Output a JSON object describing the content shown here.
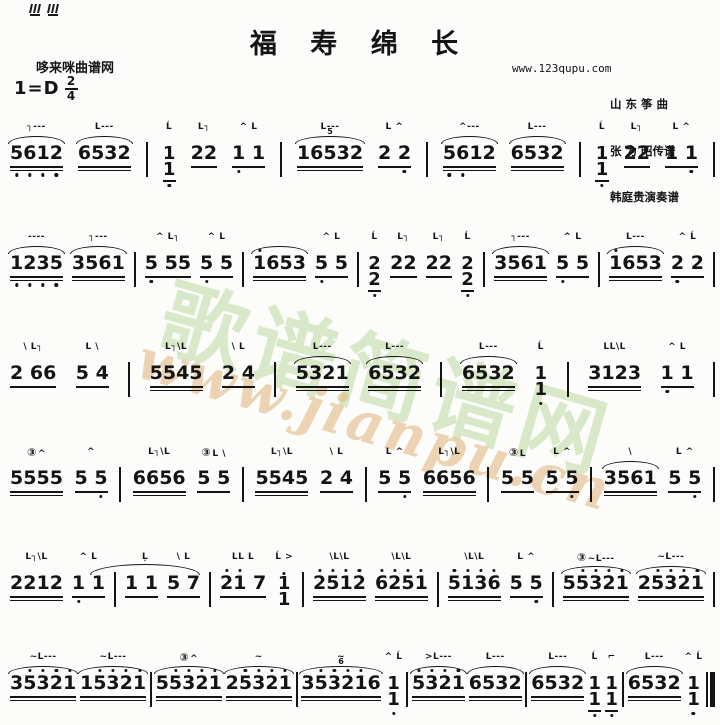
{
  "page_background": "#fcfcfa",
  "ink_color": "#141414",
  "header": {
    "title": "福 寿 绵 长",
    "site_left": "哆来咪曲谱网",
    "site_right": "www.123qupu.com",
    "key_signature": "1=D",
    "time_signature": {
      "numerator": "2",
      "denominator": "4"
    },
    "credits": [
      "山 东 筝 曲",
      "张 为 昭传谱",
      "韩庭贵演奏谱"
    ]
  },
  "watermark": {
    "site_name": "歌谱简谱网",
    "site_url": "www.jianpu.cn",
    "name_color": "#b5d698",
    "url_color": "#e2b984"
  },
  "score": {
    "notation_legend": {
      "m": "zheng-technique-marks-above",
      "a": "slur-arc",
      "t": "note-digits",
      "s": "stacked-octave-dyad",
      "u": "beam-underline-count",
      "db": "low-octave-dot-positions",
      "sd": "high-octave-dot-positions",
      "c": "circled-string-number",
      "tp": "tuplet-number",
      "tie": "tie-across-barline",
      "b": "barline (2 = final double bar)"
    },
    "lines": [
      [
        {
          "m": "┐---",
          "a": 1,
          "t": "5612",
          "u": 2,
          "db": [
            0,
            1,
            2,
            3
          ]
        },
        {
          "m": "L---",
          "a": 1,
          "t": "6532",
          "u": 2
        },
        {
          "b": 1
        },
        {
          "m": "Ĺ",
          "s": [
            "1",
            "1"
          ],
          "u": 1,
          "db": [
            0
          ]
        },
        {
          "m": "L┐",
          "t": "22",
          "u": 1
        },
        {
          "m": "^ L",
          "t": "1 1",
          "u": 1,
          "db": [
            0
          ]
        },
        {
          "b": 1
        },
        {
          "m": "L---",
          "a": 1,
          "tp": "5",
          "t": "16532",
          "u": 2
        },
        {
          "m": "L ^",
          "t": "2 2",
          "u": 1,
          "db": [
            2
          ]
        },
        {
          "b": 1
        },
        {
          "m": "^---",
          "a": 1,
          "t": "5612",
          "u": 2,
          "db": [
            0,
            1
          ]
        },
        {
          "m": "L---",
          "a": 1,
          "t": "6532",
          "u": 2
        },
        {
          "b": 1
        },
        {
          "m": "Ĺ",
          "s": [
            "1",
            "1"
          ],
          "u": 1,
          "db": [
            0
          ]
        },
        {
          "m": "L┐",
          "t": "22",
          "u": 1
        },
        {
          "m": "L ^",
          "t": "1 1",
          "u": 1,
          "db": [
            2
          ]
        },
        {
          "b": 1
        }
      ],
      [
        {
          "m": "----",
          "a": 1,
          "t": "1235",
          "u": 2,
          "db": [
            0,
            1,
            2,
            3
          ]
        },
        {
          "m": "┐---",
          "a": 1,
          "t": "3561",
          "u": 2
        },
        {
          "b": 1
        },
        {
          "m": "^ L┐",
          "t": "5 55",
          "u": 1,
          "db": [
            0
          ]
        },
        {
          "m": "^ L",
          "t": "5 5",
          "u": 1,
          "db": [
            0
          ]
        },
        {
          "b": 1
        },
        {
          "m": "",
          "a": 1,
          "t": "1653",
          "sd": [
            0
          ],
          "u": 2
        },
        {
          "m": "^ L",
          "t": "5 5",
          "u": 1,
          "db": [
            0
          ]
        },
        {
          "b": 1
        },
        {
          "m": "Ĺ",
          "s": [
            "2",
            "2"
          ],
          "u": 1,
          "db": [
            0
          ]
        },
        {
          "m": "L┐",
          "t": "22",
          "u": 1
        },
        {
          "m": "L┐",
          "t": "22",
          "u": 1
        },
        {
          "m": "Ĺ",
          "s": [
            "2",
            "2"
          ],
          "u": 1,
          "db": [
            0
          ]
        },
        {
          "b": 1
        },
        {
          "m": "┐---",
          "a": 1,
          "t": "3561",
          "u": 2
        },
        {
          "m": "^ L",
          "t": "5 5",
          "u": 1,
          "db": [
            0
          ]
        },
        {
          "b": 1
        },
        {
          "m": "L---",
          "a": 1,
          "t": "1653",
          "sd": [
            0
          ],
          "u": 2
        },
        {
          "m": "^ Ĺ",
          "t": "2 2",
          "u": 1,
          "db": [
            0
          ]
        },
        {
          "b": 1
        }
      ],
      [
        {
          "m": "\\ L┐",
          "t": "2 66",
          "u": 1
        },
        {
          "m": "L \\",
          "t": "5 4",
          "u": 1
        },
        {
          "b": 1
        },
        {
          "m": "L┐\\L",
          "t": "5545",
          "u": 2
        },
        {
          "m": "\\ L",
          "t": "2 4",
          "u": 1
        },
        {
          "b": 1
        },
        {
          "m": "L---",
          "a": 1,
          "t": "5321",
          "u": 2
        },
        {
          "m": "L---",
          "a": 1,
          "t": "6532",
          "u": 2
        },
        {
          "b": 1
        },
        {
          "m": "L---",
          "a": 1,
          "t": "6532",
          "u": 2
        },
        {
          "m": "Ĺ",
          "s": [
            "1",
            "1"
          ],
          "db": [
            0
          ]
        },
        {
          "b": 1
        },
        {
          "m": "LL\\L",
          "t": "3123",
          "u": 2
        },
        {
          "m": "^ L",
          "t": "1 1",
          "u": 1,
          "db": [
            0
          ]
        },
        {
          "b": 1
        }
      ],
      [
        {
          "c": "③",
          "m": "^",
          "t": "5555",
          "u": 2
        },
        {
          "m": "^",
          "t": "5 5",
          "u": 1,
          "db": [
            2
          ]
        },
        {
          "b": 1
        },
        {
          "m": "L┐\\L",
          "t": "6656",
          "u": 2
        },
        {
          "c": "③",
          "m": "L \\",
          "t": "5 5",
          "u": 1
        },
        {
          "b": 1
        },
        {
          "m": "L┐\\L",
          "t": "5545",
          "u": 2
        },
        {
          "m": "\\ L",
          "t": "2 4",
          "u": 1
        },
        {
          "b": 1
        },
        {
          "m": "L ^",
          "t": "5 5",
          "u": 1,
          "db": [
            2
          ]
        },
        {
          "m": "L┐\\L",
          "t": "6656",
          "u": 2
        },
        {
          "b": 1
        },
        {
          "c": "③",
          "m": "L",
          "t": "5 5",
          "u": 1
        },
        {
          "m": "L ^",
          "t": "5 5",
          "u": 1,
          "db": [
            2
          ]
        },
        {
          "b": 1
        },
        {
          "m": "\\",
          "a": 1,
          "t": "3561",
          "u": 2
        },
        {
          "m": "L ^",
          "t": "5 5",
          "u": 1,
          "db": [
            2
          ]
        },
        {
          "b": 1
        }
      ],
      [
        {
          "m": "L┐\\L",
          "t": "2212",
          "u": 2
        },
        {
          "m": "^ L",
          "t": "1 1",
          "u": 1,
          "db": [
            0
          ],
          "tie": 1
        },
        {
          "b": 1
        },
        {
          "m": "  Ļ",
          "t": "1 1",
          "u": 1
        },
        {
          "m": "\\ L",
          "t": "5 7",
          "u": 1
        },
        {
          "b": 1
        },
        {
          "m": "LL L",
          "t": "21 7",
          "sd": [
            0,
            1
          ],
          "u": 1
        },
        {
          "m": "Ĺ >",
          "s": [
            "1",
            "1"
          ],
          "ssd": 1
        },
        {
          "b": 1
        },
        {
          "m": "\\L\\L",
          "t": "2512",
          "sd": [
            0,
            1,
            2,
            3
          ],
          "u": 2
        },
        {
          "m": "\\L\\L",
          "t": "6251",
          "sd": [
            0,
            1,
            2,
            3
          ],
          "u": 2
        },
        {
          "b": 1
        },
        {
          "m": "\\L\\L",
          "t": "5136",
          "sd": [
            0,
            1,
            2,
            3
          ],
          "u": 2
        },
        {
          "m": "L ^",
          "t": "5 5",
          "u": 1,
          "db": [
            2
          ]
        },
        {
          "b": 1
        },
        {
          "c": "③",
          "m": "~L---",
          "a": 1,
          "t": "55321",
          "sd": [
            1,
            2,
            3,
            4
          ],
          "u": 2
        },
        {
          "m": "~L---",
          "a": 1,
          "t": "25321",
          "sd": [
            1,
            2,
            3,
            4
          ],
          "u": 2
        },
        {
          "b": 1
        }
      ],
      [
        {
          "m": "~L---",
          "a": 1,
          "t": "35321",
          "sd": [
            1,
            2,
            3,
            4
          ],
          "u": 2
        },
        {
          "m": "~L---",
          "a": 1,
          "t": "15321",
          "sd": [
            1,
            2,
            3,
            4
          ],
          "u": 2
        },
        {
          "b": 1
        },
        {
          "c": "③",
          "m": "^",
          "a": 1,
          "t": "55321",
          "sd": [
            1,
            2,
            3,
            4
          ],
          "u": 2
        },
        {
          "m": "~",
          "a": 1,
          "t": "25321",
          "sd": [
            1,
            2,
            3,
            4
          ],
          "u": 2
        },
        {
          "b": 1
        },
        {
          "m": "~",
          "a": 1,
          "tp": "6",
          "t": "353216",
          "sd": [
            1,
            2,
            3,
            4
          ],
          "u": 2
        },
        {
          "m": "^ Ĺ",
          "s": [
            "1",
            "1"
          ],
          "db": [
            0
          ]
        },
        {
          "b": 1
        },
        {
          "m": ">L---",
          "a": 1,
          "t": "5321",
          "sd": [
            0,
            1,
            2,
            3
          ],
          "u": 2
        },
        {
          "m": "L---",
          "a": 1,
          "t": "6532",
          "u": 2
        },
        {
          "b": 1
        },
        {
          "m": "L---",
          "a": 1,
          "t": "6532",
          "u": 2
        },
        {
          "m": "Ĺ",
          "s": [
            "1",
            "1"
          ],
          "u": 1,
          "db": [
            0
          ]
        },
        {
          "m": "⌐",
          "s": [
            "1",
            "1"
          ],
          "u": 1,
          "db": [
            0
          ]
        },
        {
          "b": 1
        },
        {
          "m": "L---",
          "a": 1,
          "t": "6532",
          "u": 2
        },
        {
          "m": "^ Ĺ",
          "s": [
            "1",
            "1"
          ],
          "db": [
            0
          ]
        },
        {
          "b": 2
        }
      ]
    ]
  }
}
